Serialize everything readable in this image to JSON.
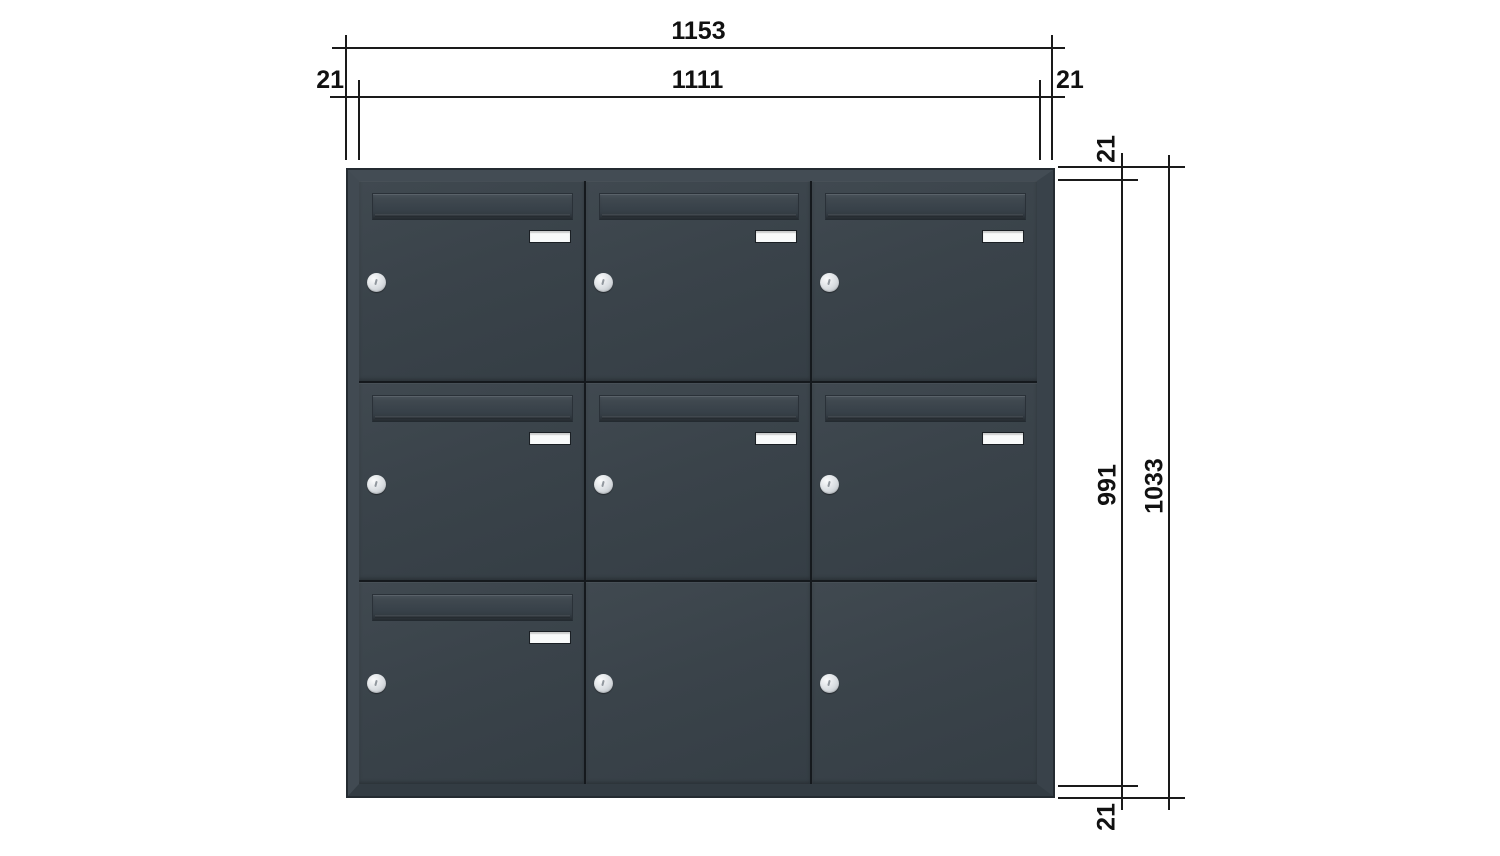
{
  "drawing": {
    "type": "technical-front-view",
    "subject": "letterbox bank 3x3 anthracite",
    "background": "#ffffff"
  },
  "dimensions": {
    "top": {
      "overall_width": "1153",
      "inner_width": "1111",
      "left_frame": "21",
      "right_frame": "21"
    },
    "right": {
      "frame_top": "21",
      "inner_height": "991",
      "overall_height": "1033",
      "frame_bottom": "21"
    }
  },
  "cabinet": {
    "rows": 3,
    "columns": 3,
    "unit_count": 9,
    "units": [
      {
        "row": 1,
        "col": 1,
        "flap": true,
        "nameplate": true,
        "lock": true
      },
      {
        "row": 1,
        "col": 2,
        "flap": true,
        "nameplate": true,
        "lock": true
      },
      {
        "row": 1,
        "col": 3,
        "flap": true,
        "nameplate": true,
        "lock": true
      },
      {
        "row": 2,
        "col": 1,
        "flap": true,
        "nameplate": true,
        "lock": true
      },
      {
        "row": 2,
        "col": 2,
        "flap": true,
        "nameplate": true,
        "lock": true
      },
      {
        "row": 2,
        "col": 3,
        "flap": true,
        "nameplate": true,
        "lock": true
      },
      {
        "row": 3,
        "col": 1,
        "flap": true,
        "nameplate": true,
        "lock": true
      },
      {
        "row": 3,
        "col": 2,
        "flap": false,
        "nameplate": false,
        "lock": true
      },
      {
        "row": 3,
        "col": 3,
        "flap": false,
        "nameplate": false,
        "lock": true
      }
    ]
  },
  "colors": {
    "body_anthracite": "#3a434a",
    "frame_highlight": "#434c54",
    "frame_shadow": "#333c43",
    "outer_edge": "#242b31",
    "seam": "#15191d",
    "nameplate_white": "#f8fafa",
    "lock_silver": "#d9dde1",
    "dimension_line": "#1a1a1a"
  }
}
